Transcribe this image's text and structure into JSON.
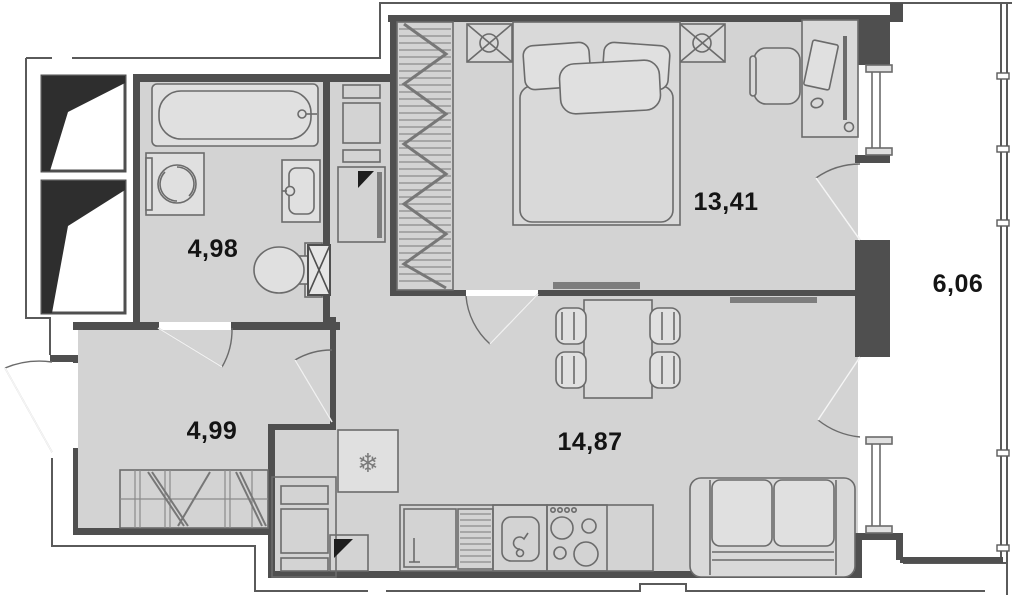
{
  "plan_title": "apartment-floor-plan",
  "rooms": {
    "bathroom": {
      "area_label": "4,98"
    },
    "bedroom": {
      "area_label": "13,41"
    },
    "hallway": {
      "area_label": "4,99"
    },
    "kitchen_living": {
      "area_label": "14,87"
    },
    "balcony": {
      "area_label": "6,06"
    }
  },
  "icons": {
    "snowflake": "❄"
  },
  "colors": {
    "background": "#ffffff",
    "floor": "#d3d3d3",
    "wall": "#4f4f4f",
    "outline": "#5a5a5a",
    "elevator_fill": "#2e2e2e",
    "label_text": "#141414"
  }
}
